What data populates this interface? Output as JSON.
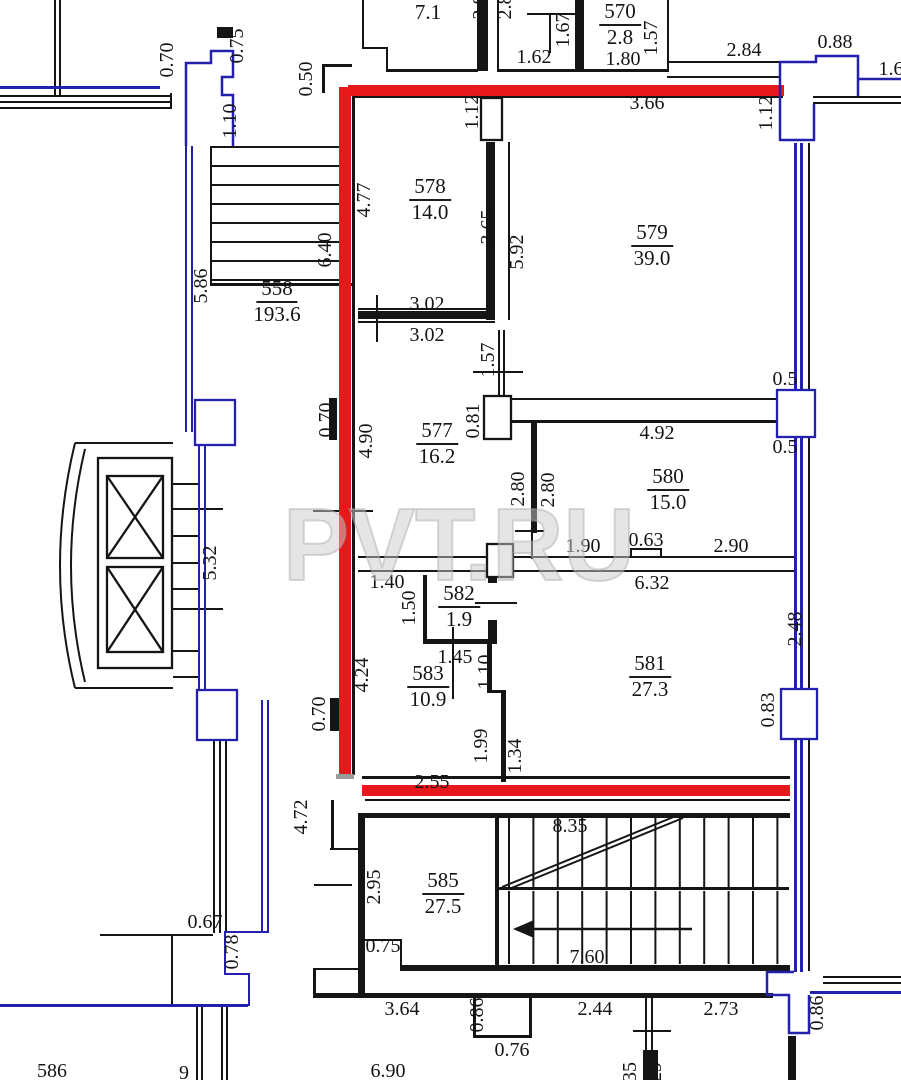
{
  "canvas": {
    "width": 901,
    "height": 1080,
    "background": "#ffffff"
  },
  "colors": {
    "wall": "#151515",
    "blue": "#2320ae",
    "red": "#e8191d",
    "grey": "#9a9a9a",
    "label": "#141414",
    "watermark": "#cbcbcb"
  },
  "watermark": {
    "text": "PVT.RU",
    "x": 283,
    "y": 580,
    "font_size": 103,
    "length": 352
  },
  "plan_rooms": [
    {
      "number": "",
      "area_m2": "7.1"
    },
    {
      "number": "570",
      "area_m2": "2.8"
    },
    {
      "number": "578",
      "area_m2": "14.0"
    },
    {
      "number": "579",
      "area_m2": "39.0"
    },
    {
      "number": "558",
      "area_m2": "193.6"
    },
    {
      "number": "577",
      "area_m2": "16.2"
    },
    {
      "number": "580",
      "area_m2": "15.0"
    },
    {
      "number": "582",
      "area_m2": "1.9"
    },
    {
      "number": "583",
      "area_m2": "10.9"
    },
    {
      "number": "581",
      "area_m2": "27.3"
    },
    {
      "number": "585",
      "area_m2": "27.5"
    },
    {
      "number": "586",
      "area_m2": ""
    }
  ],
  "room_labels": [
    {
      "number": "",
      "area": "7.1",
      "x": 428,
      "y": -2
    },
    {
      "number": "570",
      "area": "2.8",
      "x": 620,
      "y": 0
    },
    {
      "number": "578",
      "area": "14.0",
      "x": 430,
      "y": 175
    },
    {
      "number": "579",
      "area": "39.0",
      "x": 652,
      "y": 221
    },
    {
      "number": "558",
      "area": "193.6",
      "x": 277,
      "y": 277
    },
    {
      "number": "577",
      "area": "16.2",
      "x": 437,
      "y": 419
    },
    {
      "number": "580",
      "area": "15.0",
      "x": 668,
      "y": 465
    },
    {
      "number": "582",
      "area": "1.9",
      "x": 459,
      "y": 582
    },
    {
      "number": "583",
      "area": "10.9",
      "x": 428,
      "y": 662
    },
    {
      "number": "581",
      "area": "27.3",
      "x": 650,
      "y": 652
    },
    {
      "number": "585",
      "area": "27.5",
      "x": 443,
      "y": 869
    }
  ],
  "dim_labels": [
    {
      "t": "0.70",
      "x": 167,
      "y": 60,
      "r": 1
    },
    {
      "t": "0.75",
      "x": 237,
      "y": 46,
      "r": 1
    },
    {
      "t": "1.10",
      "x": 230,
      "y": 121,
      "r": 1
    },
    {
      "t": "0.50",
      "x": 306,
      "y": 79,
      "r": 1
    },
    {
      "t": "1.62",
      "x": 534,
      "y": 57,
      "r": 0
    },
    {
      "t": "1.67",
      "x": 563,
      "y": 30,
      "r": 1
    },
    {
      "t": "1.80",
      "x": 623,
      "y": 59,
      "r": 0
    },
    {
      "t": "1.57",
      "x": 651,
      "y": 38,
      "r": 1
    },
    {
      "t": "2.84",
      "x": 744,
      "y": 50,
      "r": 0
    },
    {
      "t": "0.88",
      "x": 835,
      "y": 42,
      "r": 0
    },
    {
      "t": "1.6",
      "x": 891,
      "y": 69,
      "r": 0
    },
    {
      "t": "3.66",
      "x": 647,
      "y": 103,
      "r": 0
    },
    {
      "t": "1.12",
      "x": 472,
      "y": 112,
      "r": 1
    },
    {
      "t": "1.12",
      "x": 766,
      "y": 113,
      "r": 1
    },
    {
      "t": "2.8",
      "x": 480,
      "y": 7,
      "r": 1
    },
    {
      "t": "2.8",
      "x": 505,
      "y": 7,
      "r": 1
    },
    {
      "t": "4.77",
      "x": 364,
      "y": 200,
      "r": 1
    },
    {
      "t": "3.65",
      "x": 488,
      "y": 227,
      "r": 1
    },
    {
      "t": "5.92",
      "x": 517,
      "y": 252,
      "r": 1
    },
    {
      "t": "3.02",
      "x": 427,
      "y": 304,
      "r": 0
    },
    {
      "t": "3.02",
      "x": 427,
      "y": 335,
      "r": 0
    },
    {
      "t": "5.86",
      "x": 201,
      "y": 286,
      "r": 1
    },
    {
      "t": "6.40",
      "x": 325,
      "y": 250,
      "r": 1
    },
    {
      "t": "0.70",
      "x": 326,
      "y": 420,
      "r": 1
    },
    {
      "t": "4.90",
      "x": 366,
      "y": 441,
      "r": 1
    },
    {
      "t": "1.57",
      "x": 488,
      "y": 360,
      "r": 1
    },
    {
      "t": "0.81",
      "x": 473,
      "y": 421,
      "r": 1
    },
    {
      "t": "4.92",
      "x": 657,
      "y": 433,
      "r": 0
    },
    {
      "t": "0.5",
      "x": 785,
      "y": 379,
      "r": 0
    },
    {
      "t": "0.5",
      "x": 785,
      "y": 447,
      "r": 0
    },
    {
      "t": "2.80",
      "x": 518,
      "y": 489,
      "r": 1
    },
    {
      "t": "2.80",
      "x": 548,
      "y": 490,
      "r": 1
    },
    {
      "t": "1.90",
      "x": 583,
      "y": 546,
      "r": 0
    },
    {
      "t": "0.63",
      "x": 646,
      "y": 540,
      "r": 0
    },
    {
      "t": "2.90",
      "x": 731,
      "y": 546,
      "r": 0
    },
    {
      "t": "6.32",
      "x": 652,
      "y": 583,
      "r": 0
    },
    {
      "t": "1.40",
      "x": 387,
      "y": 582,
      "r": 0
    },
    {
      "t": "1.50",
      "x": 409,
      "y": 608,
      "r": 1
    },
    {
      "t": "1.45",
      "x": 455,
      "y": 657,
      "r": 0
    },
    {
      "t": "1.10",
      "x": 485,
      "y": 672,
      "r": 1
    },
    {
      "t": "4.24",
      "x": 362,
      "y": 675,
      "r": 1
    },
    {
      "t": "0.70",
      "x": 319,
      "y": 714,
      "r": 1
    },
    {
      "t": "2.48",
      "x": 795,
      "y": 629,
      "r": 1
    },
    {
      "t": "0.83",
      "x": 768,
      "y": 710,
      "r": 1
    },
    {
      "t": "1.99",
      "x": 481,
      "y": 746,
      "r": 1
    },
    {
      "t": "1.34",
      "x": 515,
      "y": 756,
      "r": 1
    },
    {
      "t": "2.55",
      "x": 432,
      "y": 782,
      "r": 0
    },
    {
      "t": "8.35",
      "x": 570,
      "y": 826,
      "r": 0
    },
    {
      "t": "2.95",
      "x": 374,
      "y": 887,
      "r": 1
    },
    {
      "t": "0.75",
      "x": 383,
      "y": 946,
      "r": 0
    },
    {
      "t": "7.60",
      "x": 587,
      "y": 957,
      "r": 0
    },
    {
      "t": "3.64",
      "x": 402,
      "y": 1009,
      "r": 0
    },
    {
      "t": "0.86",
      "x": 477,
      "y": 1015,
      "r": 1
    },
    {
      "t": "0.76",
      "x": 512,
      "y": 1050,
      "r": 0
    },
    {
      "t": "2.44",
      "x": 595,
      "y": 1009,
      "r": 0
    },
    {
      "t": "2.73",
      "x": 721,
      "y": 1009,
      "r": 0
    },
    {
      "t": "0.86",
      "x": 817,
      "y": 1013,
      "r": 1
    },
    {
      "t": "6.90",
      "x": 388,
      "y": 1071,
      "r": 0
    },
    {
      "t": "35",
      "x": 630,
      "y": 1072,
      "r": 1
    },
    {
      "t": "29",
      "x": 655,
      "y": 1072,
      "r": 1
    },
    {
      "t": "0.67",
      "x": 205,
      "y": 922,
      "r": 0
    },
    {
      "t": "0.78",
      "x": 232,
      "y": 952,
      "r": 1
    },
    {
      "t": "4.72",
      "x": 301,
      "y": 817,
      "r": 1
    },
    {
      "t": "5.32",
      "x": 210,
      "y": 563,
      "r": 1
    },
    {
      "t": "586",
      "x": 52,
      "y": 1071,
      "r": 0
    },
    {
      "t": "9",
      "x": 184,
      "y": 1073,
      "r": 0
    }
  ],
  "drawing": {
    "black_rects": [
      [
        54,
        0,
        2,
        95
      ],
      [
        59,
        0,
        2,
        95
      ],
      [
        0,
        95,
        172,
        2
      ],
      [
        0,
        101,
        172,
        2
      ],
      [
        0,
        107,
        172,
        2
      ],
      [
        170,
        93,
        2,
        16
      ],
      [
        217,
        27,
        16,
        11
      ],
      [
        322,
        64,
        30,
        3
      ],
      [
        322,
        64,
        3,
        29
      ],
      [
        352,
        92,
        3,
        683
      ],
      [
        352,
        95,
        431,
        3
      ],
      [
        362,
        0,
        2,
        49
      ],
      [
        362,
        47,
        26,
        2
      ],
      [
        386,
        47,
        2,
        25
      ],
      [
        387,
        69,
        91,
        3
      ],
      [
        477,
        0,
        11,
        71
      ],
      [
        497,
        0,
        2,
        71
      ],
      [
        497,
        69,
        87,
        3
      ],
      [
        549,
        13,
        2,
        40
      ],
      [
        527,
        13,
        51,
        2
      ],
      [
        575,
        0,
        9,
        71
      ],
      [
        583,
        69,
        86,
        3
      ],
      [
        667,
        0,
        2,
        71
      ],
      [
        667,
        61,
        112,
        2
      ],
      [
        667,
        76,
        112,
        2
      ],
      [
        813,
        96,
        88,
        2
      ],
      [
        813,
        102,
        88,
        2
      ],
      [
        210,
        146,
        2,
        139
      ],
      [
        210,
        146,
        137,
        2
      ],
      [
        210,
        165,
        137,
        2
      ],
      [
        210,
        184,
        137,
        2
      ],
      [
        210,
        203,
        137,
        2
      ],
      [
        210,
        222,
        137,
        2
      ],
      [
        210,
        241,
        137,
        2
      ],
      [
        210,
        260,
        137,
        2
      ],
      [
        210,
        279,
        137,
        2
      ],
      [
        210,
        283,
        142,
        3
      ],
      [
        486,
        142,
        9,
        178
      ],
      [
        508,
        142,
        2,
        178
      ],
      [
        358,
        308,
        137,
        2
      ],
      [
        358,
        311,
        137,
        8
      ],
      [
        358,
        321,
        137,
        2
      ],
      [
        376,
        295,
        2,
        47
      ],
      [
        498,
        330,
        2,
        66
      ],
      [
        503,
        330,
        2,
        66
      ],
      [
        473,
        371,
        50,
        2
      ],
      [
        510,
        398,
        267,
        2
      ],
      [
        510,
        420,
        267,
        3
      ],
      [
        531,
        423,
        6,
        110
      ],
      [
        531,
        533,
        2,
        26
      ],
      [
        515,
        530,
        29,
        2
      ],
      [
        313,
        510,
        60,
        2
      ],
      [
        358,
        556,
        437,
        2
      ],
      [
        358,
        570,
        437,
        2
      ],
      [
        630,
        548,
        32,
        2
      ],
      [
        630,
        548,
        2,
        9
      ],
      [
        660,
        548,
        2,
        9
      ],
      [
        423,
        575,
        4,
        67
      ],
      [
        423,
        639,
        74,
        5
      ],
      [
        488,
        575,
        9,
        8
      ],
      [
        488,
        620,
        9,
        24
      ],
      [
        475,
        602,
        42,
        2
      ],
      [
        452,
        627,
        2,
        72
      ],
      [
        487,
        644,
        5,
        49
      ],
      [
        487,
        690,
        19,
        3
      ],
      [
        501,
        690,
        5,
        92
      ],
      [
        362,
        776,
        428,
        3
      ],
      [
        329,
        398,
        8,
        42
      ],
      [
        330,
        698,
        10,
        33
      ],
      [
        358,
        813,
        432,
        5
      ],
      [
        365,
        799,
        425,
        2
      ],
      [
        358,
        815,
        7,
        126
      ],
      [
        363,
        939,
        39,
        2
      ],
      [
        400,
        939,
        2,
        28
      ],
      [
        400,
        965,
        390,
        6
      ],
      [
        358,
        941,
        7,
        54
      ],
      [
        331,
        800,
        3,
        50
      ],
      [
        330,
        848,
        28,
        2
      ],
      [
        314,
        884,
        38,
        2
      ],
      [
        495,
        815,
        4,
        150
      ],
      [
        497,
        887,
        292,
        3
      ],
      [
        313,
        968,
        3,
        27
      ],
      [
        313,
        968,
        48,
        2
      ],
      [
        313,
        993,
        460,
        5
      ],
      [
        473,
        996,
        3,
        42
      ],
      [
        529,
        996,
        3,
        42
      ],
      [
        473,
        1035,
        59,
        3
      ],
      [
        645,
        996,
        2,
        84
      ],
      [
        651,
        996,
        2,
        84
      ],
      [
        633,
        1030,
        38,
        2
      ],
      [
        643,
        1050,
        15,
        30
      ],
      [
        823,
        976,
        78,
        2
      ],
      [
        823,
        982,
        78,
        2
      ],
      [
        788,
        1036,
        8,
        44
      ],
      [
        196,
        1007,
        2,
        73
      ],
      [
        201,
        1007,
        2,
        73
      ],
      [
        221,
        1007,
        2,
        73
      ],
      [
        226,
        1007,
        2,
        73
      ],
      [
        213,
        700,
        2,
        233
      ],
      [
        219,
        700,
        2,
        233
      ],
      [
        225,
        700,
        2,
        233
      ],
      [
        100,
        934,
        113,
        2
      ],
      [
        171,
        936,
        2,
        68
      ],
      [
        150,
        508,
        73,
        2
      ],
      [
        150,
        608,
        73,
        2
      ],
      [
        173,
        483,
        25,
        2
      ],
      [
        173,
        535,
        25,
        2
      ],
      [
        173,
        562,
        25,
        2
      ],
      [
        173,
        588,
        25,
        2
      ],
      [
        173,
        650,
        25,
        2
      ],
      [
        173,
        676,
        25,
        2
      ],
      [
        75,
        442,
        98,
        2
      ],
      [
        75,
        687,
        98,
        2
      ],
      [
        808,
        143,
        2,
        828
      ]
    ],
    "blue_rects": [
      [
        0,
        86,
        160,
        3
      ],
      [
        185,
        146,
        2,
        286
      ],
      [
        191,
        146,
        2,
        286
      ],
      [
        198,
        432,
        2,
        260
      ],
      [
        204,
        432,
        2,
        260
      ],
      [
        261,
        700,
        2,
        233
      ],
      [
        267,
        700,
        2,
        233
      ],
      [
        224,
        931,
        43,
        2
      ],
      [
        224,
        931,
        2,
        44
      ],
      [
        224,
        973,
        26,
        2
      ],
      [
        248,
        973,
        2,
        33
      ],
      [
        0,
        1004,
        248,
        3
      ],
      [
        794,
        143,
        3,
        247
      ],
      [
        800,
        143,
        3,
        247
      ],
      [
        794,
        437,
        3,
        253
      ],
      [
        800,
        437,
        3,
        253
      ],
      [
        794,
        740,
        3,
        232
      ],
      [
        800,
        740,
        3,
        232
      ],
      [
        810,
        991,
        91,
        3
      ]
    ],
    "red_rects": [
      [
        339,
        87,
        12,
        690
      ],
      [
        348,
        85,
        436,
        11
      ],
      [
        362,
        785,
        428,
        11
      ]
    ],
    "grey_rects": [
      [
        336,
        774,
        18,
        5
      ]
    ],
    "boxes": [
      {
        "x": 481,
        "y": 98,
        "w": 21,
        "h": 42,
        "s": "wall",
        "cross": false
      },
      {
        "x": 484,
        "y": 396,
        "w": 27,
        "h": 43,
        "s": "wall",
        "cross": false
      },
      {
        "x": 777,
        "y": 390,
        "w": 38,
        "h": 47,
        "s": "blue",
        "cross": false
      },
      {
        "x": 781,
        "y": 689,
        "w": 36,
        "h": 50,
        "s": "blue",
        "cross": false
      },
      {
        "x": 487,
        "y": 544,
        "w": 26,
        "h": 33,
        "s": "wall",
        "cross": false
      },
      {
        "x": 98,
        "y": 458,
        "w": 74,
        "h": 210,
        "s": "wall",
        "cross": false
      },
      {
        "x": 107,
        "y": 476,
        "w": 56,
        "h": 82,
        "s": "wall",
        "cross": true
      },
      {
        "x": 107,
        "y": 567,
        "w": 56,
        "h": 85,
        "s": "wall",
        "cross": true
      },
      {
        "x": 195,
        "y": 400,
        "w": 40,
        "h": 45,
        "s": "blue",
        "cross": false
      },
      {
        "x": 197,
        "y": 690,
        "w": 40,
        "h": 50,
        "s": "blue",
        "cross": false
      }
    ],
    "lines": [
      [
        502,
        887,
        676,
        816,
        2
      ],
      [
        509,
        889,
        683,
        818,
        2
      ],
      [
        532,
        929,
        692,
        929,
        2.5
      ]
    ],
    "paths": [
      {
        "d": "M75,443 Q45,566 75,688",
        "w": 2,
        "c": "wall"
      },
      {
        "d": "M85,449 Q57,566 85,682",
        "w": 2,
        "c": "wall"
      },
      {
        "d": "M780,141 L780,62 L816,62 L816,56 L858,56 L858,79 L901,79 M780,140 L814,140 L814,104 M858,79 L858,96",
        "w": 2.5,
        "c": "blue"
      },
      {
        "d": "M794,972 L767,972 L767,995 L789,995 L789,1033 L809,1033 L809,995",
        "w": 2.5,
        "c": "blue"
      },
      {
        "d": "M186,146 L186,63 L211,63 L211,51 L233,51 L233,77 L222,77 L222,95 L233,95 L233,146",
        "w": 2.5,
        "c": "blue"
      }
    ],
    "polys": [
      {
        "points": "513,929 534,920 534,938"
      }
    ],
    "stairs": [
      {
        "x0": 509,
        "step": 24.4,
        "count": 12,
        "y1": 818,
        "y2": 887
      },
      {
        "x0": 509,
        "step": 24.4,
        "count": 12,
        "y1": 891,
        "y2": 964
      }
    ]
  }
}
